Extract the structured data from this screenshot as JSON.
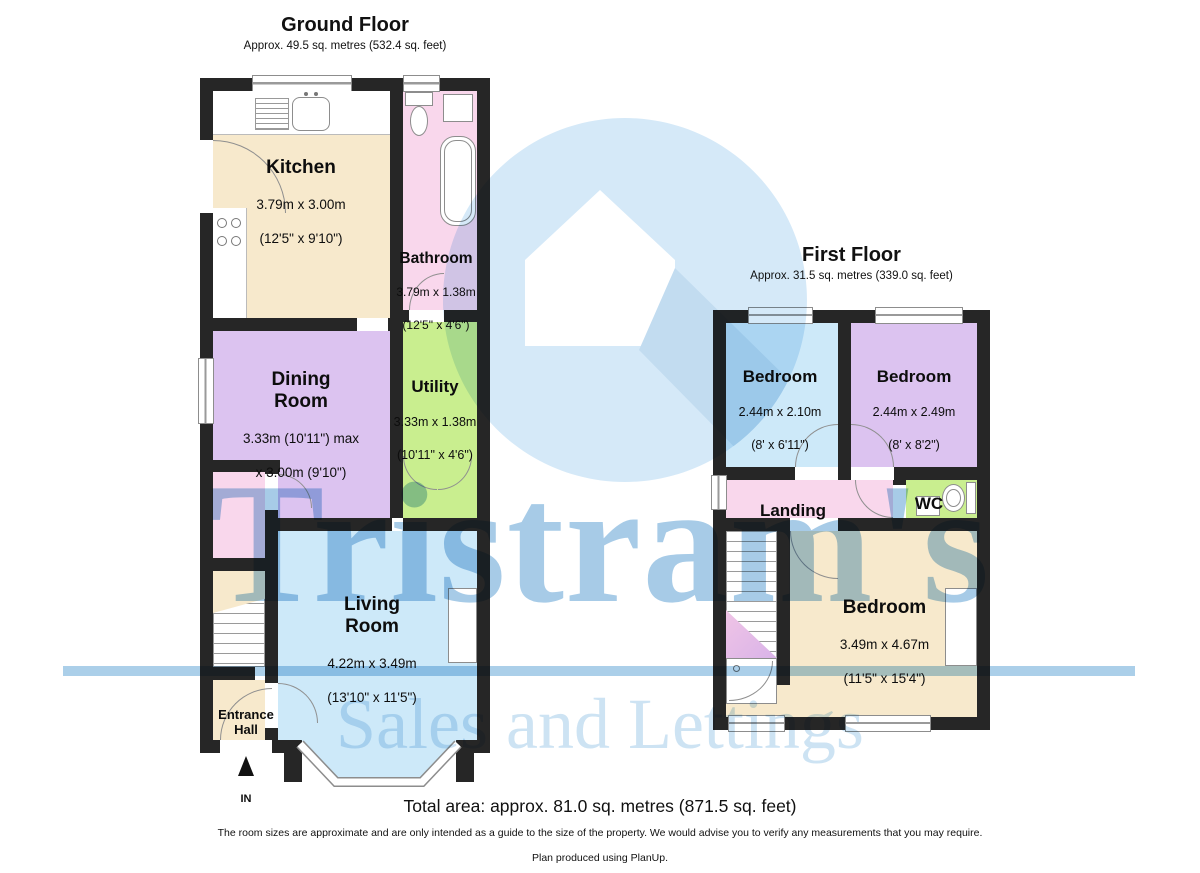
{
  "brand": {
    "name": "Tristram's",
    "tagline": "Sales and Lettings"
  },
  "gf": {
    "title": "Ground Floor",
    "subtitle": "Approx. 49.5 sq. metres (532.4 sq. feet)",
    "kitchen": {
      "name": "Kitchen",
      "d1": "3.79m x 3.00m",
      "d2": "(12'5\" x 9'10\")"
    },
    "bathroom": {
      "name": "Bathroom",
      "d1": "3.79m x 1.38m",
      "d2": "(12'5\" x 4'6\")"
    },
    "dining": {
      "name": "Dining\nRoom",
      "d1": "3.33m (10'11\") max",
      "d2": "x 3.00m (9'10\")"
    },
    "utility": {
      "name": "Utility",
      "d1": "3.33m x 1.38m",
      "d2": "(10'11\" x 4'6\")"
    },
    "living": {
      "name": "Living\nRoom",
      "d1": "4.22m x 3.49m",
      "d2": "(13'10\" x 11'5\")"
    },
    "entrance": {
      "name": "Entrance\nHall"
    },
    "in_label": "IN"
  },
  "ff": {
    "title": "First Floor",
    "subtitle": "Approx. 31.5 sq. metres (339.0 sq. feet)",
    "bed1": {
      "name": "Bedroom",
      "d1": "2.44m x 2.10m",
      "d2": "(8' x 6'11\")"
    },
    "bed2": {
      "name": "Bedroom",
      "d1": "2.44m x 2.49m",
      "d2": "(8' x 8'2\")"
    },
    "bed3": {
      "name": "Bedroom",
      "d1": "3.49m x 4.67m",
      "d2": "(11'5\" x 15'4\")"
    },
    "landing": {
      "name": "Landing"
    },
    "wc": {
      "name": "WC"
    }
  },
  "footer": {
    "total": "Total area: approx. 81.0 sq. metres (871.5 sq. feet)",
    "note": "The room sizes are approximate and are only intended as a guide to the size of the property. We would advise you to verify any measurements that you may require.",
    "credit": "Plan produced using PlanUp."
  },
  "colors": {
    "wall": "#262626",
    "room_cream": "#f7e9cc",
    "room_pink": "#f9d7ec",
    "room_purple": "#dcc3f0",
    "room_green": "#c9ee8f",
    "room_blue": "#cde9f9",
    "watermark_text": "#a7cbe7",
    "watermark_tagline": "#cde3f3",
    "watermark_circle": "#d5e9f8"
  }
}
